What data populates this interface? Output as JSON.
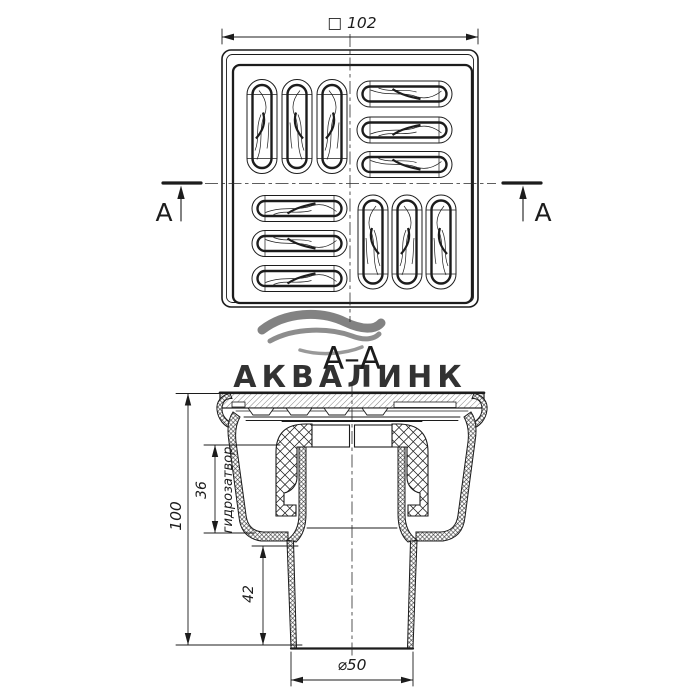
{
  "drawing": {
    "title_section": "А–А",
    "watermark": "АКВАЛИНК",
    "section_marker": "А",
    "dims": {
      "width_square": "□ 102",
      "height_overall": "100",
      "seal_height": "36",
      "seal_label": "гидрозатвор",
      "outlet_height": "42",
      "outlet_diameter": "⌀50"
    },
    "colors": {
      "line": "#1c1c1c",
      "watermark": "#b4cbda",
      "background": "#ffffff"
    }
  }
}
